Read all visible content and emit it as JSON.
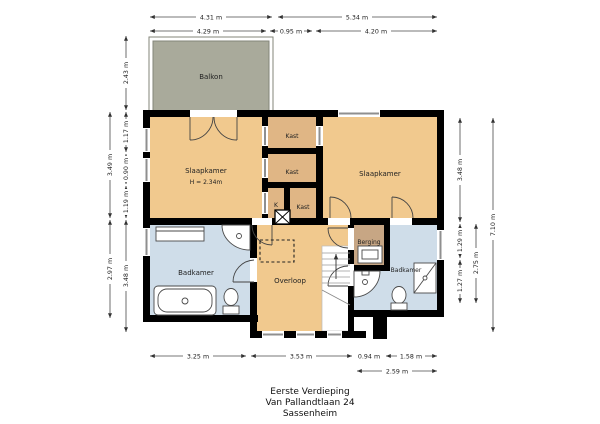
{
  "title": {
    "building_level": "Eerste Verdieping",
    "street": "Van Pallandtlaan 24",
    "city": "Sassenheim"
  },
  "rooms": {
    "balkon": {
      "label": "Balkon"
    },
    "slaapkamer_left": {
      "label": "Slaapkamer",
      "ceiling_height": "H = 2.34m"
    },
    "slaapkamer_right": {
      "label": "Slaapkamer"
    },
    "kast_top": {
      "label": "Kast"
    },
    "kast_mid": {
      "label": "Kast"
    },
    "kast_k": {
      "label": "K"
    },
    "kast_bottom": {
      "label": "Kast"
    },
    "badkamer_left": {
      "label": "Badkamer"
    },
    "badkamer_right": {
      "label": "Badkamer"
    },
    "overloop": {
      "label": "Overloop"
    },
    "berging": {
      "label": "Berging"
    }
  },
  "dimensions": {
    "top_outer_left": "4.31 m",
    "top_outer_right": "5.34 m",
    "top_inner_left": "4.29 m",
    "top_inner_mid": "0.95 m",
    "top_inner_right": "4.20 m",
    "bottom_left": "3.25 m",
    "bottom_mid": "3.53 m",
    "bottom_small": "0.94 m",
    "bottom_right": "1.58 m",
    "bottom_right_total": "2.59 m",
    "left_outer_upper": "3.49 m",
    "left_outer_lower": "2.97 m",
    "left_inner_balcony": "2.43 m",
    "left_inner_1": "1.17 m",
    "left_inner_2": "0.90 m",
    "left_inner_3": "1.19 m",
    "left_inner_4": "3.48 m",
    "right_inner_upper": "3.48 m",
    "right_inner_mid": "1.29 m",
    "right_inner_lower": "1.27 m",
    "right_mid_total": "2.75 m",
    "right_outer_total": "7.10 m"
  },
  "colors": {
    "wall": "#000000",
    "room_tan": "#f1c98e",
    "closet_tan": "#e0b685",
    "bathroom_blue": "#cfdde9",
    "storage_brown": "#c7a684",
    "balcony_grey": "#a9aa9b",
    "window_grey": "#8f8f8f",
    "paper": "#ffffff"
  }
}
